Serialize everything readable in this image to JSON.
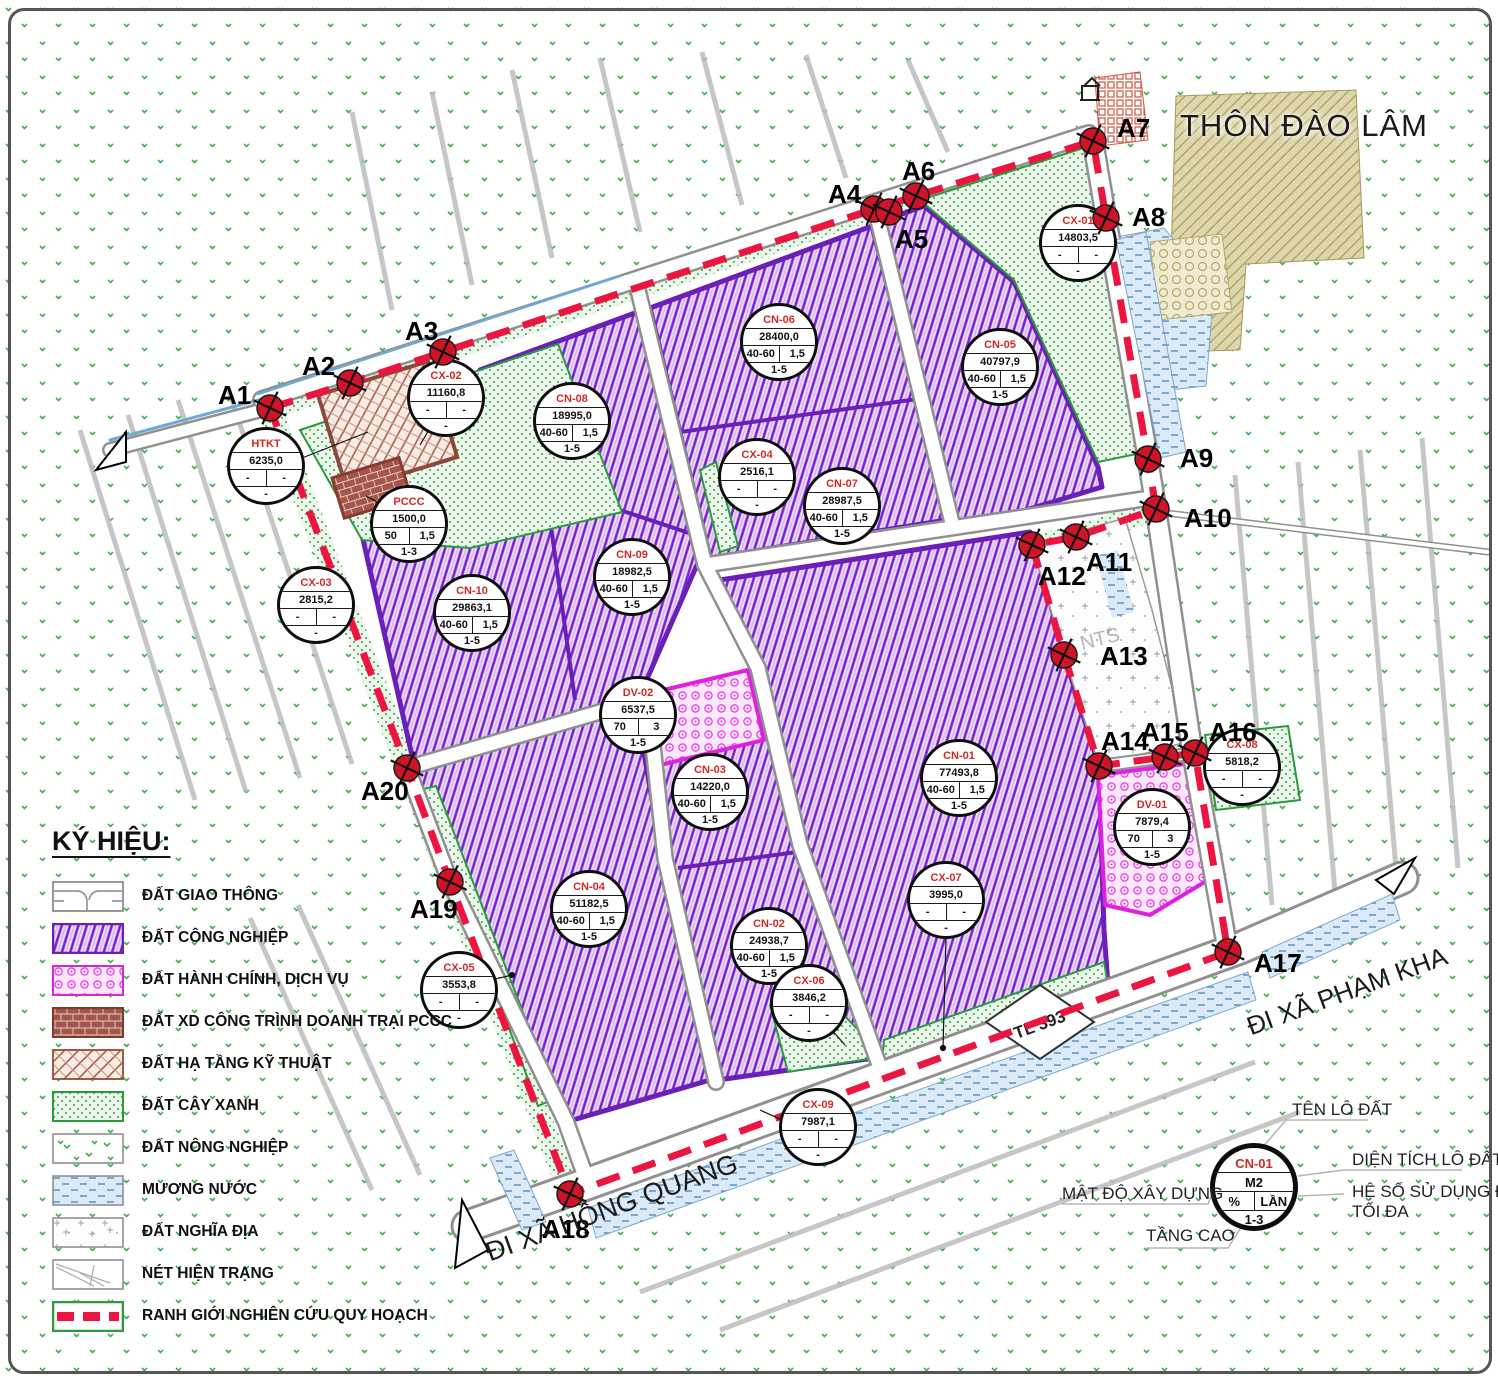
{
  "labels": {
    "village": "THÔN ĐÀO LÂM",
    "road_bottom": "ĐI XÃ HỒNG QUANG",
    "road_right": "ĐI XÃ PHẠM KHA",
    "route": "TL 393",
    "cemetery": "NTS"
  },
  "colors": {
    "industrial": "#7a22cf",
    "service_pink": "#e23ae2",
    "green": "#35a04a",
    "boundary_red": "#ec1540",
    "marker_red": "#d01428",
    "water_blue": "#5a92c0"
  },
  "boundary_points": [
    {
      "label": "A1",
      "x": 270,
      "y": 408,
      "lx": -52,
      "ly": -28
    },
    {
      "label": "A2",
      "x": 350,
      "y": 383,
      "lx": -48,
      "ly": -32
    },
    {
      "label": "A3",
      "x": 443,
      "y": 352,
      "lx": -38,
      "ly": -36
    },
    {
      "label": "A4",
      "x": 874,
      "y": 209,
      "lx": -46,
      "ly": -30
    },
    {
      "label": "A5",
      "x": 889,
      "y": 212,
      "lx": 6,
      "ly": 12
    },
    {
      "label": "A6",
      "x": 916,
      "y": 196,
      "lx": -14,
      "ly": -40
    },
    {
      "label": "A7",
      "x": 1093,
      "y": 141,
      "lx": 24,
      "ly": -28
    },
    {
      "label": "A8",
      "x": 1106,
      "y": 218,
      "lx": 26,
      "ly": -16
    },
    {
      "label": "A9",
      "x": 1148,
      "y": 459,
      "lx": 32,
      "ly": -16
    },
    {
      "label": "A10",
      "x": 1156,
      "y": 509,
      "lx": 28,
      "ly": -6
    },
    {
      "label": "A11",
      "x": 1076,
      "y": 537,
      "lx": 10,
      "ly": 10
    },
    {
      "label": "A12",
      "x": 1032,
      "y": 545,
      "lx": 6,
      "ly": 16
    },
    {
      "label": "A13",
      "x": 1064,
      "y": 655,
      "lx": 36,
      "ly": -14
    },
    {
      "label": "A14",
      "x": 1099,
      "y": 766,
      "lx": 2,
      "ly": -40
    },
    {
      "label": "A15",
      "x": 1165,
      "y": 757,
      "lx": -24,
      "ly": -40
    },
    {
      "label": "A16",
      "x": 1195,
      "y": 753,
      "lx": 14,
      "ly": -36
    },
    {
      "label": "A17",
      "x": 1228,
      "y": 952,
      "lx": 26,
      "ly": -4
    },
    {
      "label": "A18",
      "x": 570,
      "y": 1194,
      "lx": -28,
      "ly": 20
    },
    {
      "label": "A19",
      "x": 450,
      "y": 882,
      "lx": -40,
      "ly": 12
    },
    {
      "label": "A20",
      "x": 407,
      "y": 768,
      "lx": -46,
      "ly": 8
    }
  ],
  "parcels": [
    {
      "id": "CX-01",
      "area": "14803,5",
      "density": "-",
      "coef": "-",
      "floors": "-",
      "x": 1078,
      "y": 243
    },
    {
      "id": "CN-06",
      "area": "28400,0",
      "density": "40-60",
      "coef": "1,5",
      "floors": "1-5",
      "x": 779,
      "y": 342
    },
    {
      "id": "CN-05",
      "area": "40797,9",
      "density": "40-60",
      "coef": "1,5",
      "floors": "1-5",
      "x": 1000,
      "y": 367
    },
    {
      "id": "CX-02",
      "area": "11160,8",
      "density": "-",
      "coef": "-",
      "floors": "-",
      "x": 446,
      "y": 398
    },
    {
      "id": "CN-08",
      "area": "18995,0",
      "density": "40-60",
      "coef": "1,5",
      "floors": "1-5",
      "x": 572,
      "y": 421
    },
    {
      "id": "HTKT",
      "area": "6235,0",
      "density": "-",
      "coef": "-",
      "floors": "-",
      "x": 266,
      "y": 466
    },
    {
      "id": "CX-04",
      "area": "2516,1",
      "density": "-",
      "coef": "-",
      "floors": "-",
      "x": 757,
      "y": 477
    },
    {
      "id": "CN-07",
      "area": "28987,5",
      "density": "40-60",
      "coef": "1,5",
      "floors": "1-5",
      "x": 842,
      "y": 506
    },
    {
      "id": "PCCC",
      "area": "1500,0",
      "density": "50",
      "coef": "1,5",
      "floors": "1-3",
      "x": 409,
      "y": 524
    },
    {
      "id": "CN-09",
      "area": "18982,5",
      "density": "40-60",
      "coef": "1,5",
      "floors": "1-5",
      "x": 632,
      "y": 577
    },
    {
      "id": "CX-03",
      "area": "2815,2",
      "density": "-",
      "coef": "-",
      "floors": "-",
      "x": 316,
      "y": 605
    },
    {
      "id": "CN-10",
      "area": "29863,1",
      "density": "40-60",
      "coef": "1,5",
      "floors": "1-5",
      "x": 472,
      "y": 613
    },
    {
      "id": "DV-02",
      "area": "6537,5",
      "density": "70",
      "coef": "3",
      "floors": "1-5",
      "x": 638,
      "y": 715
    },
    {
      "id": "CN-01",
      "area": "77493,8",
      "density": "40-60",
      "coef": "1,5",
      "floors": "1-5",
      "x": 959,
      "y": 778
    },
    {
      "id": "CX-08",
      "area": "5818,2",
      "density": "-",
      "coef": "-",
      "floors": "-",
      "x": 1242,
      "y": 767
    },
    {
      "id": "CN-03",
      "area": "14220,0",
      "density": "40-60",
      "coef": "1,5",
      "floors": "1-5",
      "x": 710,
      "y": 792
    },
    {
      "id": "DV-01",
      "area": "7879,4",
      "density": "70",
      "coef": "3",
      "floors": "1-5",
      "x": 1152,
      "y": 827
    },
    {
      "id": "CX-07",
      "area": "3995,0",
      "density": "-",
      "coef": "-",
      "floors": "-",
      "x": 946,
      "y": 900
    },
    {
      "id": "CN-04",
      "area": "51182,5",
      "density": "40-60",
      "coef": "1,5",
      "floors": "1-5",
      "x": 589,
      "y": 909
    },
    {
      "id": "CN-02",
      "area": "24938,7",
      "density": "40-60",
      "coef": "1,5",
      "floors": "1-5",
      "x": 769,
      "y": 946
    },
    {
      "id": "CX-05",
      "area": "3553,8",
      "density": "-",
      "coef": "-",
      "floors": "-",
      "x": 459,
      "y": 990
    },
    {
      "id": "CX-06",
      "area": "3846,2",
      "density": "-",
      "coef": "-",
      "floors": "-",
      "x": 809,
      "y": 1003
    },
    {
      "id": "CX-09",
      "area": "7987,1",
      "density": "-",
      "coef": "-",
      "floors": "-",
      "x": 818,
      "y": 1127
    }
  ],
  "legend": {
    "title": "KÝ HIỆU:",
    "items": [
      {
        "key": "giao-thong",
        "label": "ĐẤT GIAO THÔNG"
      },
      {
        "key": "cong-nghiep",
        "label": "ĐẤT CÔNG NGHIỆP"
      },
      {
        "key": "hanh-chinh",
        "label": "ĐẤT HÀNH CHÍNH, DỊCH VỤ"
      },
      {
        "key": "pccc",
        "label": "ĐẤT XD CÔNG TRÌNH DOANH TRẠI PCCC"
      },
      {
        "key": "ha-tang",
        "label": "ĐẤT HẠ TẦNG KỸ THUẬT"
      },
      {
        "key": "cay-xanh",
        "label": "ĐẤT CÂY XANH"
      },
      {
        "key": "nong-nghiep",
        "label": "ĐẤT NÔNG NGHIỆP"
      },
      {
        "key": "muong-nuoc",
        "label": "MƯƠNG NƯỚC"
      },
      {
        "key": "nghia-dia",
        "label": "ĐẤT NGHĨA ĐỊA"
      },
      {
        "key": "hien-trang",
        "label": "NÉT HIỆN TRẠNG"
      },
      {
        "key": "ranh-gioi",
        "label": "RANH GIỚI NGHIÊN CỨU QUY HOẠCH"
      }
    ]
  },
  "symbol_key": {
    "name": "CN-01",
    "area": "M2",
    "density": "%",
    "coef": "LẦN",
    "floors": "1-3",
    "callouts": {
      "name": "TÊN LÔ ĐẤT",
      "area": "DIỆN TÍCH LÔ ĐẤT",
      "density": "MẬT ĐỘ XÂY DỰNG",
      "coef": "HỆ SỐ SỬ DỤNG ĐẤT",
      "coef2": "TỐI ĐA",
      "floors": "TẦNG CAO"
    }
  }
}
